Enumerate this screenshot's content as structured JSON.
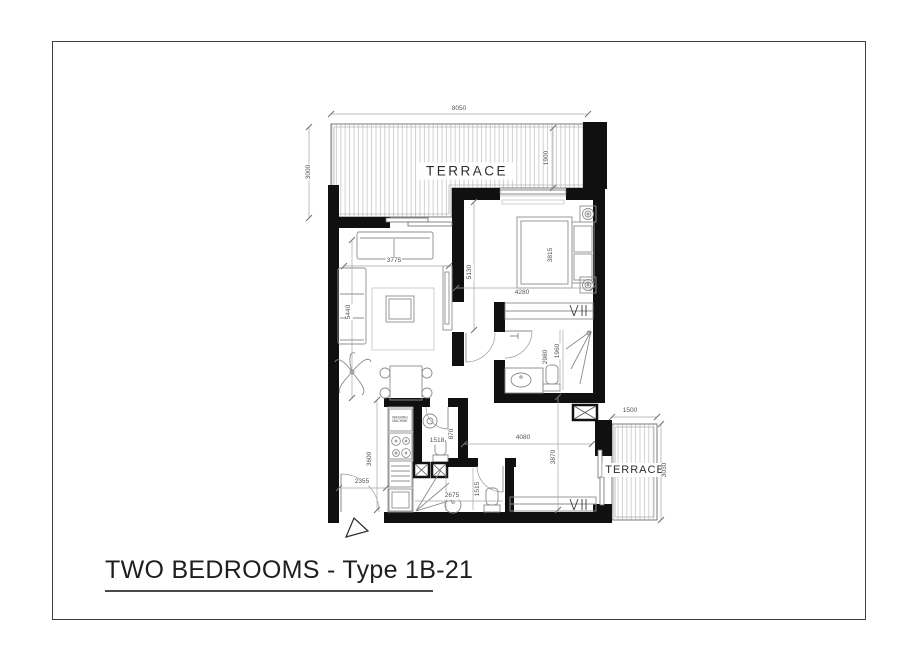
{
  "title_block": {
    "text": "TWO BEDROOMS - Type 1B-21"
  },
  "rooms": {
    "terrace_top": "TERRACE",
    "terrace_right": "TERRACE"
  },
  "appliances": {
    "washing_machine": "WASHING\nMACHINE"
  },
  "dimensions": {
    "terrace_width": "8050",
    "terrace_depth_left": "3000",
    "terrace_depth_right": "1900",
    "living_width": "3775",
    "living_depth": "5440",
    "bedroom_depth": "5130",
    "bedroom_width": "4280",
    "bed_length": "3815",
    "bathroom1_width": "2980",
    "bathroom1_depth": "1960",
    "hall_width": "4080",
    "hall_depth": "3870",
    "terrace2_width": "1500",
    "terrace2_depth": "3030",
    "kitchen_depth": "3600",
    "entry_width": "2355",
    "wc_width": "1518",
    "wc_depth": "870",
    "bathroom2_width": "2675",
    "bathroom2_depth": "1515"
  }
}
